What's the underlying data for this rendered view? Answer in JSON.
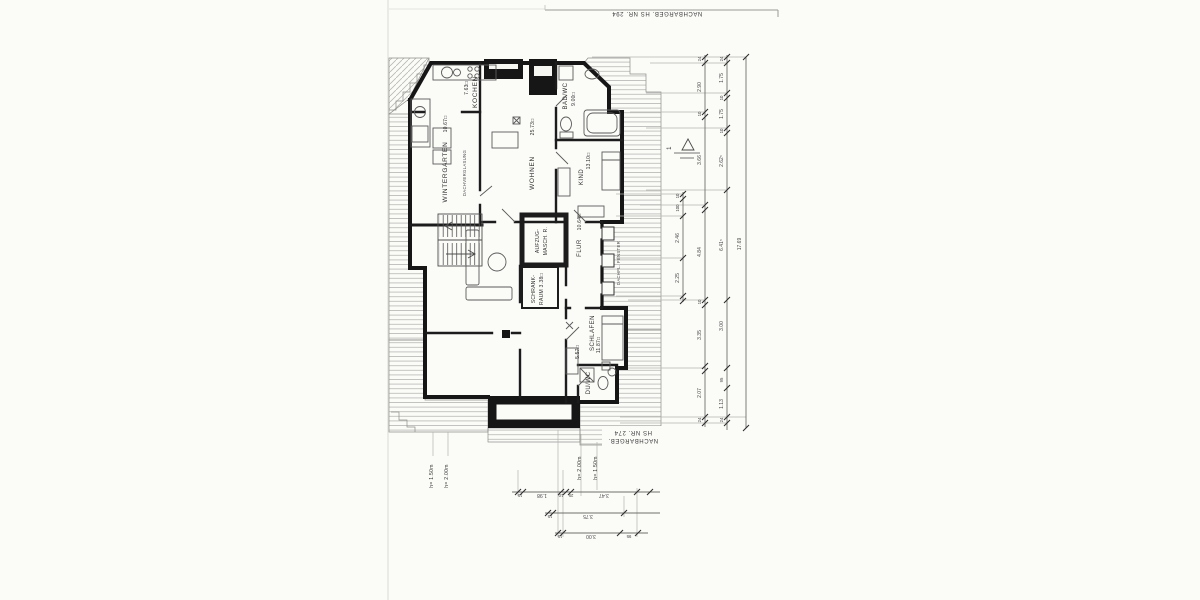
{
  "scan": {
    "neighbor_top": "NACHBARGEB. HS NR. 294",
    "neighbor_bottom_line1": "NACHBARGEB.",
    "neighbor_bottom_line2": "HS NR. 274",
    "section_marker": "1"
  },
  "rooms": {
    "kochen": {
      "name": "KOCHEN",
      "area": "7.63□"
    },
    "wintergarten": {
      "name": "WINTERGARTEN",
      "area": "10.67□"
    },
    "wohnen": {
      "name": "WOHNEN",
      "area": "25.73□"
    },
    "bad": {
      "name": "BAD/WC",
      "area": "9.00□"
    },
    "kind": {
      "name": "KIND",
      "area": "13.10□"
    },
    "flur": {
      "name": "FLUR",
      "area": "10.64□"
    },
    "schlafen": {
      "name": "SCHLAFEN",
      "area": "11.87□"
    },
    "duwc": {
      "name": "DU/WC",
      "area": "5.57□"
    },
    "aufzug": {
      "line1": "AUFZUG-",
      "line2": "MASCH. R."
    },
    "schrank": {
      "line1": "SCHRANK-",
      "line2": "RAUM 3.38□"
    },
    "dachverglasung": "DACHVERGLASUNG",
    "dachfenster": "DACHFL. FENSTER"
  },
  "dims": {
    "ra": [
      "10",
      "100",
      "2.46",
      "2.25"
    ],
    "rb": [
      "24",
      "2.90",
      "10",
      "3.66",
      "4.84",
      "10",
      "3.35",
      "2.07",
      "24"
    ],
    "rc": [
      "24",
      "1.75",
      "10",
      "1.75",
      "10",
      "2.62⁵",
      "6.41⁵",
      "3.00",
      "95",
      "1.13",
      "24"
    ],
    "rd": [
      "17.69"
    ],
    "b1": [
      "15",
      "1.98",
      "10",
      "25",
      "3.47"
    ],
    "b2": [
      "15",
      "3.75"
    ],
    "b3": [
      "15",
      "3.00",
      "95"
    ],
    "heights": [
      "h= 1.50m",
      "h= 2.00m",
      "h= 2.00m",
      "h= 1.50m"
    ]
  }
}
